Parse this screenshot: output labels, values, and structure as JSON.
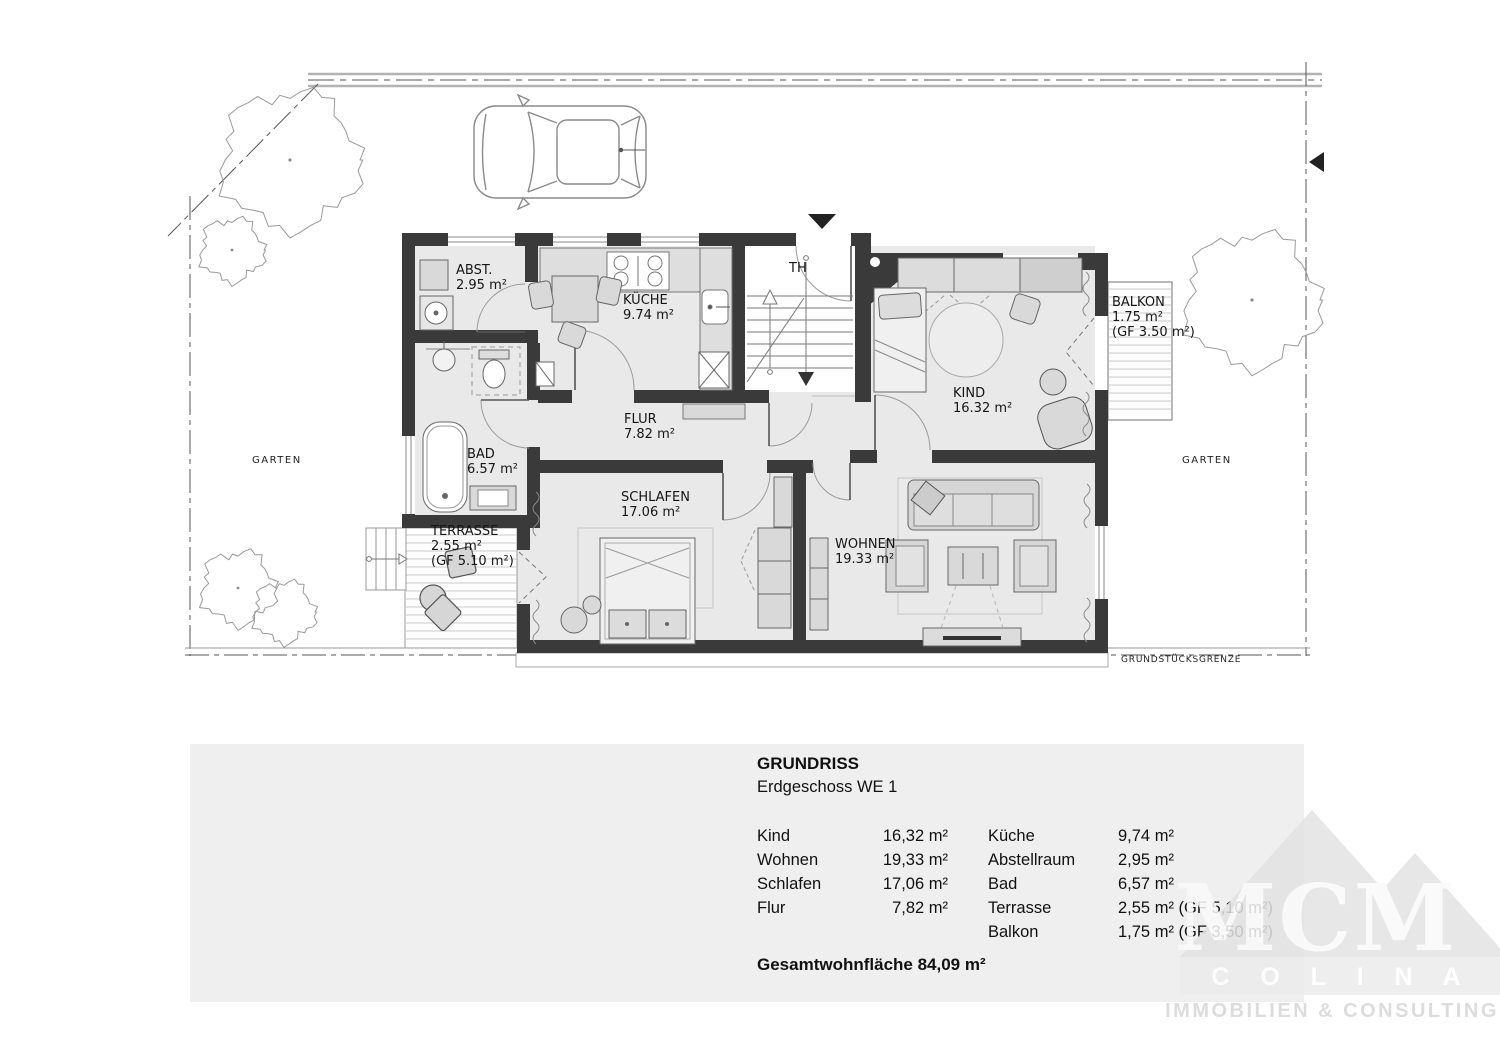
{
  "plan": {
    "rooms": {
      "abst": {
        "name": "ABST.",
        "area": "2.95 m²"
      },
      "kueche": {
        "name": "KÜCHE",
        "area": "9.74 m²"
      },
      "th": {
        "name": "TH"
      },
      "kind": {
        "name": "KIND",
        "area": "16.32 m²"
      },
      "balkon": {
        "name": "BALKON",
        "area": "1.75 m²",
        "area_gf": "(GF 3.50 m²)"
      },
      "bad": {
        "name": "BAD",
        "area": "6.57 m²"
      },
      "flur": {
        "name": "FLUR",
        "area": "7.82 m²"
      },
      "schlafen": {
        "name": "SCHLAFEN",
        "area": "17.06 m²"
      },
      "wohnen": {
        "name": "WOHNEN",
        "area": "19.33 m²"
      },
      "terrasse": {
        "name": "TERRASSE",
        "area": "2.55 m²",
        "area_gf": "(GF 5.10 m²)"
      }
    },
    "labels": {
      "garten_left": "GARTEN",
      "garten_right": "GARTEN",
      "boundary": "GRUNDSTÜCKSGRENZE"
    }
  },
  "panel": {
    "title": "GRUNDRISS",
    "subtitle": "Erdgeschoss WE 1",
    "rows_left": [
      {
        "label": "Kind",
        "value": "16,32 m²"
      },
      {
        "label": "Wohnen",
        "value": "19,33 m²"
      },
      {
        "label": "Schlafen",
        "value": "17,06 m²"
      },
      {
        "label": "Flur",
        "value": "7,82 m²"
      }
    ],
    "rows_right": [
      {
        "label": "Küche",
        "value": "9,74 m²"
      },
      {
        "label": "Abstellraum",
        "value": "2,95 m²"
      },
      {
        "label": "Bad",
        "value": "6,57 m²"
      },
      {
        "label": "Terrasse",
        "value": "2,55 m² (GF 5,10 m²)"
      },
      {
        "label": "Balkon",
        "value": "1,75 m² (GF 3,50 m²)"
      }
    ],
    "total": "Gesamtwohnfläche 84,09 m²"
  },
  "watermark": {
    "monogram": "MCM",
    "name": "C O L I N A",
    "tagline": "IMMOBILIEN & CONSULTING"
  },
  "colors": {
    "wall": "#3a3a3a",
    "floor": "#e9e9e9",
    "furniture": "#d9d9d9",
    "panel_bg": "#efefef",
    "watermark": "#e3e3e3"
  }
}
